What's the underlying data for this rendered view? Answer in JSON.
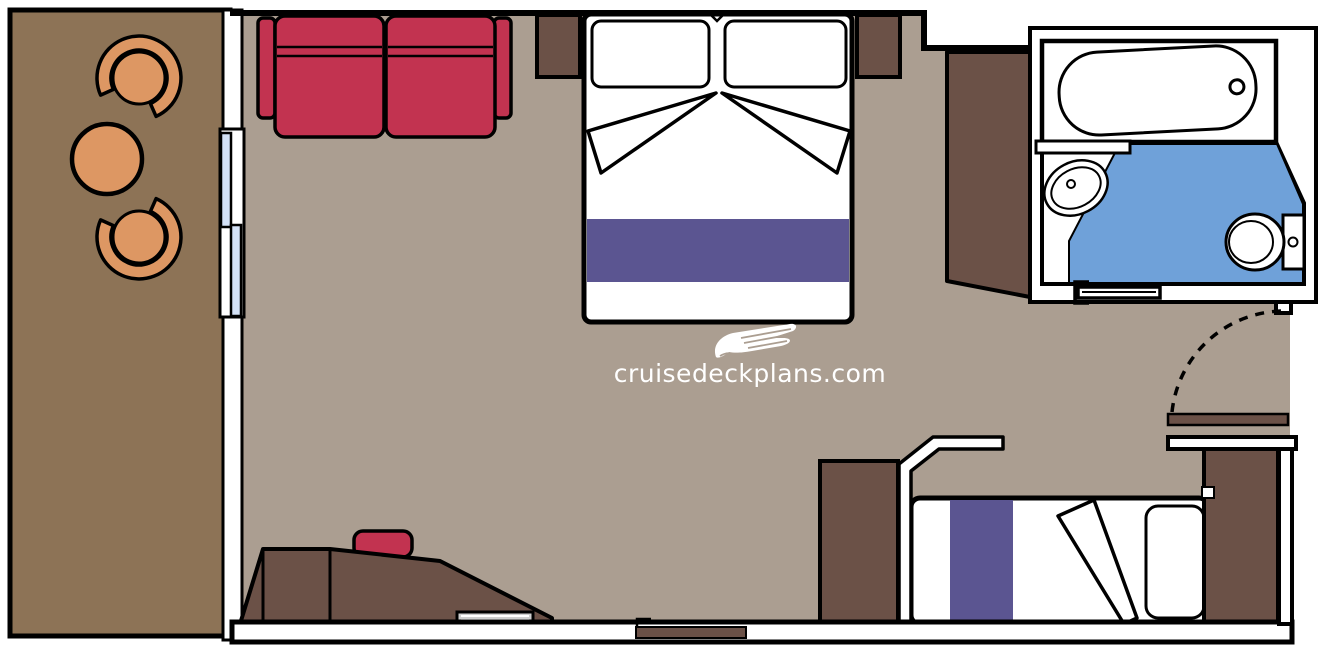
{
  "watermark": {
    "text": "cruisedeckplans.com",
    "icon": "cruise-ship-icon"
  },
  "colors": {
    "cabin-floor": "#ab9e91",
    "balcony-floor": "#8d7356",
    "wood-furniture": "#6b5147",
    "sofa-red": "#c23350",
    "bedding-purple": "#5b5591",
    "bathroom-blue": "#6fa1d9",
    "glass-blue": "#d3e1f6",
    "balcony-furniture-tan": "#dd9763",
    "tray-gray": "#cfcfcf",
    "wall-fill": "#ffffff",
    "outline": "#000000"
  },
  "rooms": [
    "balcony",
    "stateroom",
    "bathroom",
    "entry"
  ],
  "legend": [
    "balcony-chair",
    "balcony-table",
    "sliding-glass-door",
    "sofa",
    "queen-bed",
    "pillow",
    "nightstand",
    "wardrobe",
    "desk",
    "stool",
    "single-bed",
    "closet",
    "bathtub",
    "sink",
    "toilet",
    "bathroom-sliding-door",
    "entry-door",
    "door-swing-arc"
  ]
}
